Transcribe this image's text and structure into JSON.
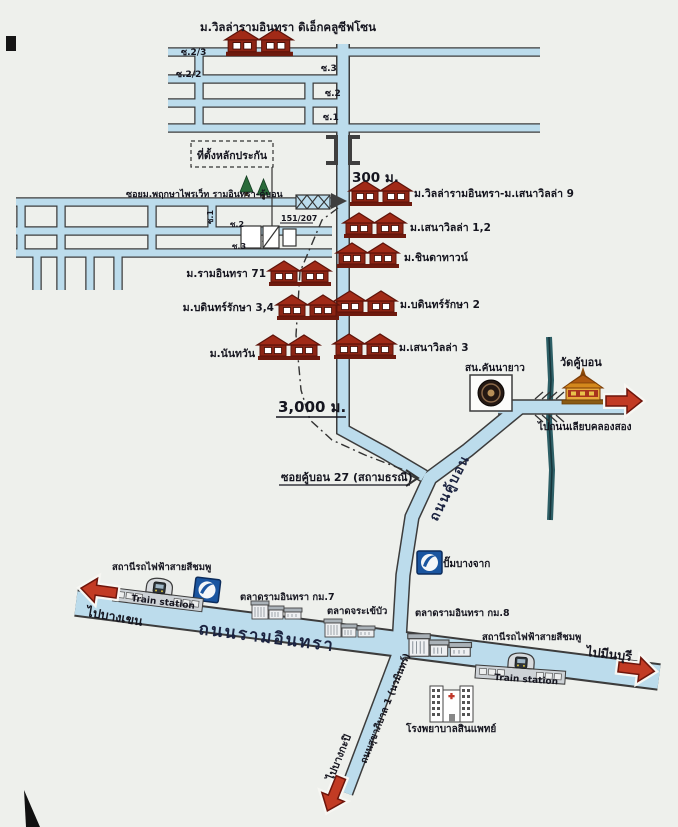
{
  "colors": {
    "paper": "#eef0ec",
    "road_fill": "#bcdcec",
    "road_edge": "#3c3c3c",
    "roof_red": "#9e2a16",
    "arrow_red": "#c23b24",
    "canal_teal": "#2d5f66",
    "bangchak_blue": "#1a55a0",
    "ink": "#15151f"
  },
  "top_area": {
    "village": "ม.วิลล่ารามอินทรา ดิเอ็กคลูซีฟโซน",
    "sois": [
      "ซ.2/3",
      "ซ.2/2",
      "ซ.3",
      "ซ.2",
      "ซ.1"
    ]
  },
  "collateral": {
    "box_label": "ที่ตั้งหลักประกัน",
    "house_no": "151/207",
    "distance_300": "300 ม.",
    "distance_3000": "3,000 ม."
  },
  "left_area": {
    "soi_label": "ซอยม.พฤกษาไพรเว็ท รามอินทรา-คู้บอน",
    "sois": [
      "ซ.1",
      "ซ.2",
      "ซ.3"
    ]
  },
  "villages_right": [
    "ม.วิลล่ารามอินทรา-ม.เสนาวิลล่า 9",
    "ม.เสนาวิลล่า 1,2",
    "ม.ชินดาทาวน์",
    "ม.บดินทร์รักษา 2",
    "ม.เสนาวิลล่า 3"
  ],
  "villages_left": [
    "ม.รามอินทรา 71",
    "ม.บดินทร์รักษา 3,4",
    "ม.นันทวัน"
  ],
  "roads": {
    "ramintra": "ถนนรามอินทรา",
    "khubon": "ถนนคู้บอน",
    "sukhaphiban": "ถนนสุขาภิบาล 1 (นวมินทร์)",
    "soi_khubon27": "ซอยคู้บอน 27 (สถามธรณี)",
    "to_khlong_song": "ไปถนนเลียบคลองสอง",
    "to_bangkhen": "ไปบางเขน",
    "to_minburi": "ไปมีนบุรี",
    "to_bangkapi": "ไปบางกะปิ"
  },
  "landmarks": {
    "police_station": "สน.คันนายาว",
    "temple": "วัดคู้บอน",
    "gas_station": "ปั๊มบางจาก",
    "market_km7": "ตลาดรามอินทรา กม.7",
    "market_chorakhebua": "ตลาดจระเข้บัว",
    "market_km8": "ตลาดรามอินทรา กม.8",
    "hospital": "โรงพยาบาลสินแพทย์",
    "station_pink_left": "สถานีรถไฟฟ้าสายสีชมพู",
    "station_pink_right": "สถานีรถไฟฟ้าสายสีชมพู",
    "train_station_en": "Train station"
  }
}
